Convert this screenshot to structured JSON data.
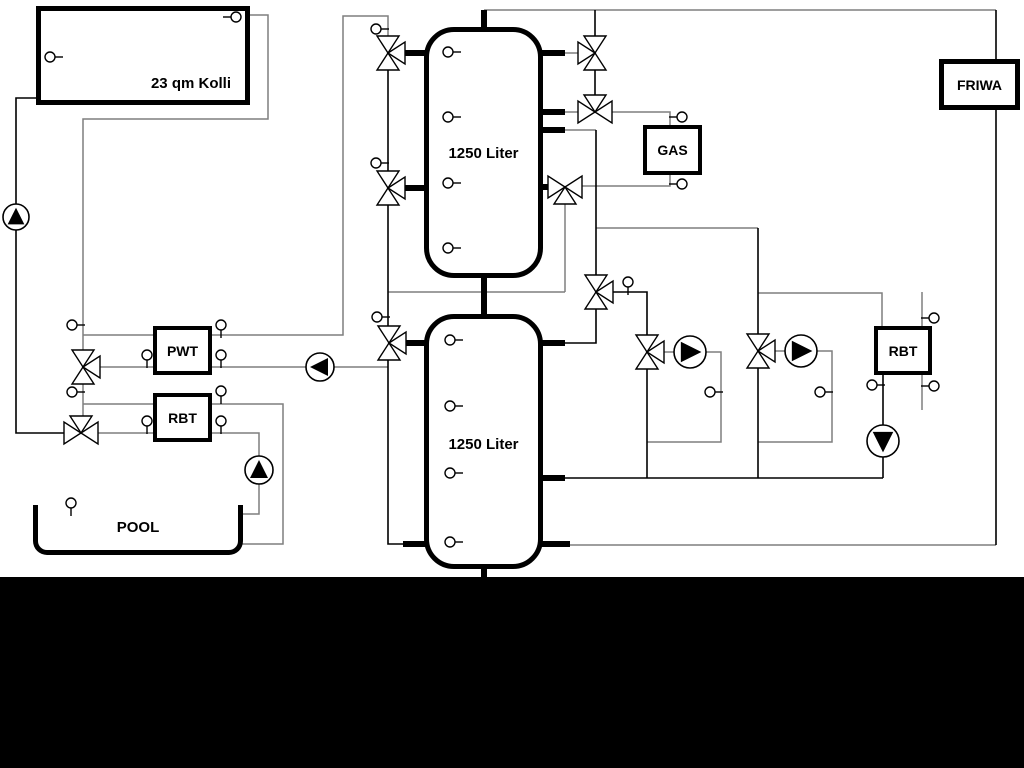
{
  "colors": {
    "background": "#ffffff",
    "pipe_gray": "#7f7f7f",
    "pipe_black": "#000000",
    "band": "#000000"
  },
  "boxes": {
    "collector": {
      "label": "23 qm Kolli"
    },
    "tank_top": {
      "label": "1250 Liter"
    },
    "tank_bottom": {
      "label": "1250 Liter"
    },
    "pwt": {
      "label": "PWT"
    },
    "rbt_left": {
      "label": "RBT"
    },
    "gas": {
      "label": "GAS"
    },
    "rbt_right": {
      "label": "RBT"
    },
    "friwa": {
      "label": "FRIWA"
    },
    "pool": {
      "label": "POOL"
    }
  },
  "components": {
    "pumps": [
      {
        "name": "solar-pump-icon",
        "x": 16,
        "y": 217,
        "r": 13,
        "dir": "up"
      },
      {
        "name": "pwt-charge-pump-icon",
        "x": 320,
        "y": 367,
        "r": 14,
        "dir": "left"
      },
      {
        "name": "pool-pump-icon",
        "x": 259,
        "y": 470,
        "r": 14,
        "dir": "up"
      },
      {
        "name": "heating-pump-1-icon",
        "x": 690,
        "y": 352,
        "r": 16,
        "dir": "right"
      },
      {
        "name": "heating-pump-2-icon",
        "x": 801,
        "y": 351,
        "r": 16,
        "dir": "right"
      },
      {
        "name": "rbt-right-pump-icon",
        "x": 883,
        "y": 441,
        "r": 16,
        "dir": "down"
      }
    ],
    "valves": [
      {
        "name": "valve-tank1-top-left-icon",
        "x": 388,
        "y": 53,
        "ports": "TBR"
      },
      {
        "name": "valve-tank1-bottom-left-icon",
        "x": 388,
        "y": 188,
        "ports": "TBR"
      },
      {
        "name": "valve-tank2-top-left-icon",
        "x": 389,
        "y": 343,
        "ports": "TBR"
      },
      {
        "name": "valve-pwt-icon",
        "x": 83,
        "y": 367,
        "ports": "TBR"
      },
      {
        "name": "valve-pool-icon",
        "x": 81,
        "y": 433,
        "ports": "LRT"
      },
      {
        "name": "valve-tank1-top-right-icon",
        "x": 595,
        "y": 53,
        "ports": "TBL"
      },
      {
        "name": "valve-gas-supply-icon",
        "x": 595,
        "y": 112,
        "ports": "LRT"
      },
      {
        "name": "valve-gas-return-icon",
        "x": 565,
        "y": 187,
        "ports": "LRB"
      },
      {
        "name": "valve-mixer-center-icon",
        "x": 596,
        "y": 292,
        "ports": "TBR"
      },
      {
        "name": "valve-heating-1-icon",
        "x": 647,
        "y": 352,
        "ports": "TBR"
      },
      {
        "name": "valve-heating-2-icon",
        "x": 758,
        "y": 351,
        "ports": "TBR"
      }
    ],
    "sensors": [
      {
        "name": "sensor-collector-left-icon",
        "x": 50,
        "y": 57,
        "tail": "right"
      },
      {
        "name": "sensor-collector-right-icon",
        "x": 236,
        "y": 17,
        "tail": "left"
      },
      {
        "name": "sensor-riser-1-icon",
        "x": 376,
        "y": 29,
        "tail": "right"
      },
      {
        "name": "sensor-riser-2-icon",
        "x": 376,
        "y": 163,
        "tail": "right"
      },
      {
        "name": "sensor-riser-3-icon",
        "x": 377,
        "y": 317,
        "tail": "right"
      },
      {
        "name": "sensor-tank1-1-icon",
        "x": 448,
        "y": 52,
        "tail": "right"
      },
      {
        "name": "sensor-tank1-2-icon",
        "x": 448,
        "y": 117,
        "tail": "right"
      },
      {
        "name": "sensor-tank1-3-icon",
        "x": 448,
        "y": 183,
        "tail": "right"
      },
      {
        "name": "sensor-tank1-4-icon",
        "x": 448,
        "y": 248,
        "tail": "right"
      },
      {
        "name": "sensor-tank2-1-icon",
        "x": 450,
        "y": 340,
        "tail": "right"
      },
      {
        "name": "sensor-tank2-2-icon",
        "x": 450,
        "y": 406,
        "tail": "right"
      },
      {
        "name": "sensor-tank2-3-icon",
        "x": 450,
        "y": 473,
        "tail": "right"
      },
      {
        "name": "sensor-tank2-4-icon",
        "x": 450,
        "y": 542,
        "tail": "right"
      },
      {
        "name": "sensor-left-riser-1-icon",
        "x": 72,
        "y": 325,
        "tail": "right"
      },
      {
        "name": "sensor-left-riser-2-icon",
        "x": 72,
        "y": 392,
        "tail": "right"
      },
      {
        "name": "sensor-pwt-right-top-icon",
        "x": 221,
        "y": 325,
        "tail": "down"
      },
      {
        "name": "sensor-pwt-left-icon",
        "x": 147,
        "y": 355,
        "tail": "down"
      },
      {
        "name": "sensor-pwt-right-icon",
        "x": 221,
        "y": 355,
        "tail": "down"
      },
      {
        "name": "sensor-rbt-left-top-icon",
        "x": 221,
        "y": 391,
        "tail": "down"
      },
      {
        "name": "sensor-rbt-left-in-icon",
        "x": 147,
        "y": 421,
        "tail": "down"
      },
      {
        "name": "sensor-rbt-left-out-icon",
        "x": 221,
        "y": 421,
        "tail": "down"
      },
      {
        "name": "sensor-pool-icon",
        "x": 71,
        "y": 503,
        "tail": "down"
      },
      {
        "name": "sensor-gas-top-icon",
        "x": 682,
        "y": 117,
        "tail": "left"
      },
      {
        "name": "sensor-gas-bottom-icon",
        "x": 682,
        "y": 184,
        "tail": "left"
      },
      {
        "name": "sensor-mixer-icon",
        "x": 628,
        "y": 282,
        "tail": "down"
      },
      {
        "name": "sensor-heating-1-icon",
        "x": 710,
        "y": 392,
        "tail": "right"
      },
      {
        "name": "sensor-heating-2-icon",
        "x": 820,
        "y": 392,
        "tail": "right"
      },
      {
        "name": "sensor-rbt-right-left-icon",
        "x": 872,
        "y": 385,
        "tail": "right"
      },
      {
        "name": "sensor-rbt-right-top-icon",
        "x": 934,
        "y": 318,
        "tail": "left"
      },
      {
        "name": "sensor-rbt-right-bot-icon",
        "x": 934,
        "y": 386,
        "tail": "left"
      }
    ]
  }
}
